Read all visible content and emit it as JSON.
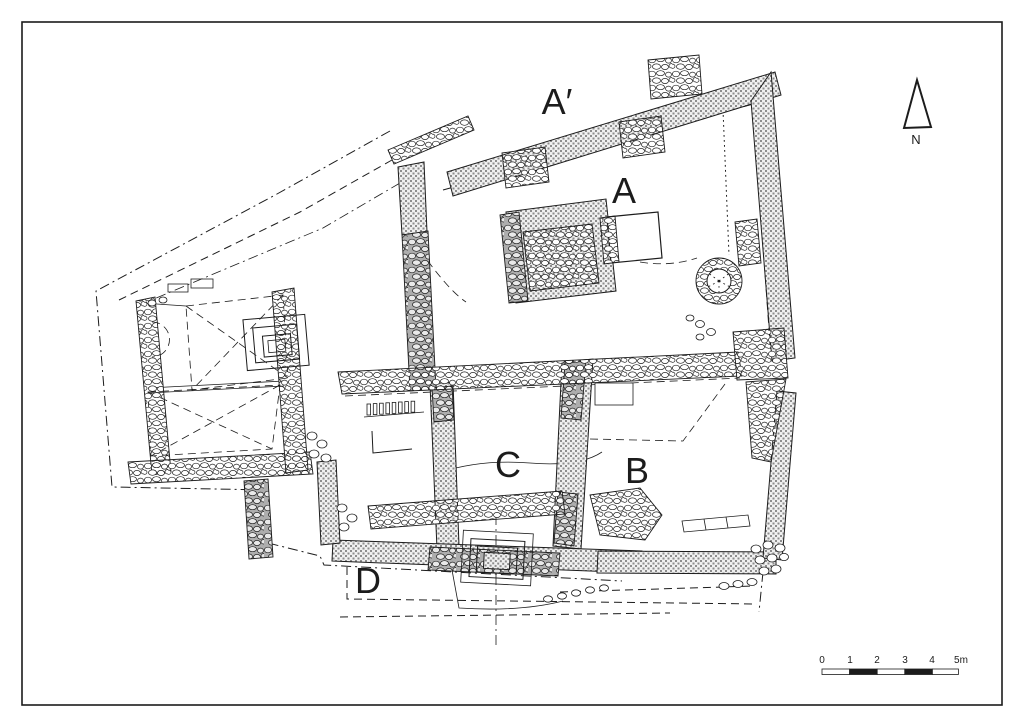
{
  "figure": {
    "colors": {
      "ink": "#1c1c1c",
      "hatch_dot": "#8d8d8d",
      "hatch_bg": "#f0f0f0",
      "paper": "#ffffff",
      "stone_dark_bg": "#adadad"
    },
    "area_labels": [
      {
        "id": "a-prime",
        "text": "A′"
      },
      {
        "id": "a",
        "text": "A"
      },
      {
        "id": "b",
        "text": "B"
      },
      {
        "id": "c",
        "text": "C"
      },
      {
        "id": "d",
        "text": "D"
      }
    ],
    "north_arrow": {
      "label": "N"
    },
    "scale_bar": {
      "tick_labels": [
        "0",
        "1",
        "2",
        "3",
        "4"
      ],
      "end_label": "5m"
    }
  }
}
